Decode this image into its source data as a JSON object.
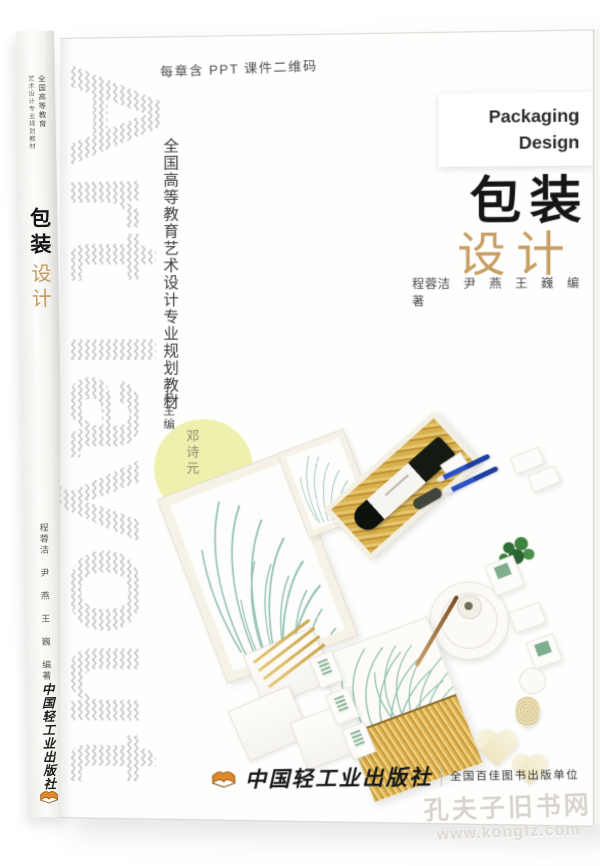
{
  "top_note": "每章含 PPT 课件二维码",
  "cover": {
    "art_text": "Art layout",
    "series_title": "全国高等教育艺术设计专业规划教材",
    "chief_editor_label": "总主编",
    "chief_editor_name": "邓诗元",
    "title_en_line1": "Packaging",
    "title_en_line2": "Design",
    "title_cn_line1": "包装",
    "title_cn_line2": "设计",
    "authors": "程蓉洁　尹　燕　王　巍　编著",
    "publisher_name": "中国轻工业出版社",
    "publisher_badge": "全国百佳图书出版单位"
  },
  "spine": {
    "series_col_a": "全国高等教育",
    "series_col_b": "艺术设计专业规划教材",
    "title_line1": "包装",
    "title_line2": "设计",
    "authors": "程蓉洁 尹 燕 王 巍 编著",
    "publisher_name": "中国轻工业出版社"
  },
  "watermark": {
    "site_name": "孔夫子旧书网",
    "site_url": "www.kongfz.com"
  },
  "photo_items": [
    "botanical-print-frame",
    "small-print-card",
    "wine-gift-box",
    "wine-bottle",
    "blue-pens",
    "bottle-opener",
    "green-plant",
    "round-plate",
    "teacup",
    "botanical-wheat-card",
    "envelopes",
    "stamp-cards",
    "wheat-stalks",
    "pencil",
    "heart-dishes",
    "twine-coil"
  ],
  "colors": {
    "title_tan": "#c79e63",
    "yellow_circle": "#eef0ad",
    "chevron_gray": "#c7c7c7",
    "publisher_orange": "#e0882a",
    "print_teal": "#93c1b0",
    "wheat_gold": "#d9ab49",
    "pen_blue": "#2a52c8"
  }
}
